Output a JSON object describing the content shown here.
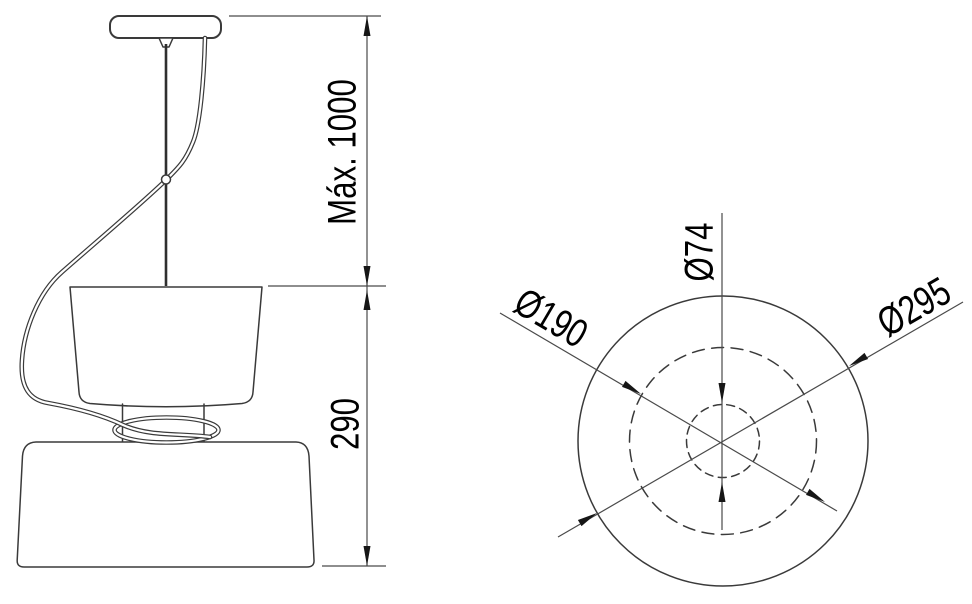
{
  "drawing": {
    "kind": "pendant-lamp-dimension-drawing",
    "side_view": {
      "dim_suspension_label": "Máx. 1000",
      "dim_body_height_label": "290"
    },
    "plan_view": {
      "dim_inner_diameter_label": "Ø74",
      "dim_middle_diameter_label": "Ø190",
      "dim_outer_diameter_label": "Ø295"
    },
    "colors": {
      "object_line": "#3a3a3a",
      "dimension_line": "#4a4a4a",
      "text": "#000000",
      "background": "#ffffff"
    }
  }
}
